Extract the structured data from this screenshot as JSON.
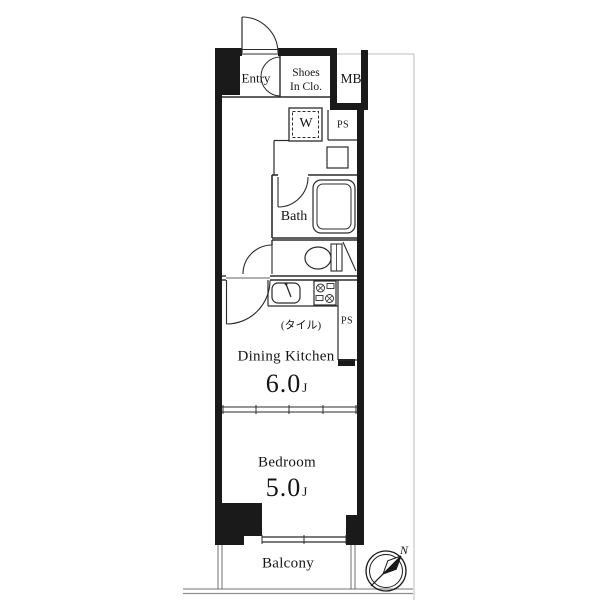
{
  "title": "apartment-floor-plan",
  "colors": {
    "wall": "#1a1a1a",
    "line": "#2b2b2b",
    "faint": "#c9c9c9",
    "ground": "#8f8f8f"
  },
  "rooms": {
    "entry": {
      "label": "Entry"
    },
    "shoes_closet": {
      "line1": "Shoes",
      "line2": "In Clo."
    },
    "meter_box": {
      "label": "MB"
    },
    "bath": {
      "label": "Bath"
    },
    "dining_kitchen": {
      "label": "Dining Kitchen",
      "note": "(タイル)",
      "size": "6.0",
      "size_unit": "J"
    },
    "bedroom": {
      "label": "Bedroom",
      "size": "5.0",
      "size_unit": "J"
    },
    "balcony": {
      "label": "Balcony"
    }
  },
  "fixtures": {
    "washer": {
      "label": "W"
    },
    "pipe_space_top": {
      "label": "PS"
    },
    "pipe_space_bottom": {
      "label": "PS"
    }
  },
  "compass": {
    "north_label": "N"
  }
}
